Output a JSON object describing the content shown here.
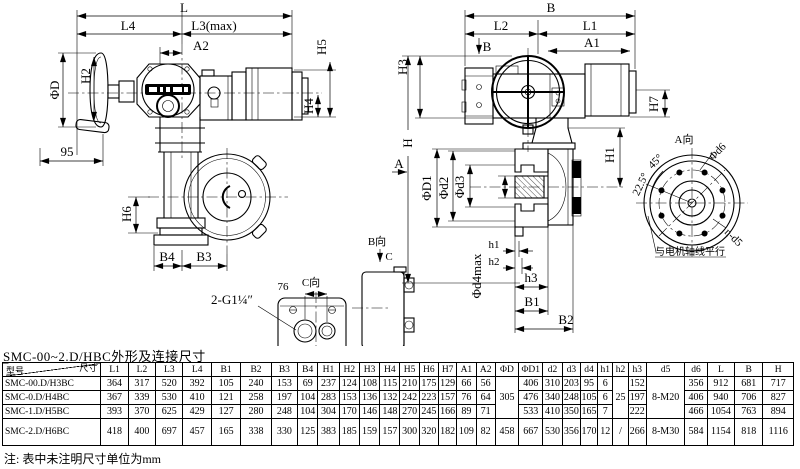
{
  "page": {
    "title": "SMC-00~2.D/HBC外形及连接尺寸",
    "note": "注: 表中未注明尺寸单位为mm"
  },
  "front_view": {
    "L": "L",
    "L4": "L4",
    "L3max": "L3(max)",
    "A2": "A2",
    "phiD": "ΦD",
    "H2": "H2",
    "H5": "H5",
    "H4": "H4",
    "n95": "95",
    "H6": "H6",
    "B4": "B4",
    "B3": "B3",
    "thread": "2-G1¼″",
    "n76": "76",
    "c_view_title": "C向",
    "b_view_title": "B向",
    "c_arrow": "C"
  },
  "side_view": {
    "B": "B",
    "L2": "L2",
    "L1": "L1",
    "A1": "A1",
    "b_arrow": "B",
    "H3": "H3",
    "H": "H",
    "a_arrow": "A",
    "H7": "H7",
    "H1": "H1",
    "phiD1": "ΦD1",
    "phid2": "Φd2",
    "phid3": "Φd3",
    "phid4max": "Φd4max",
    "h1": "h1",
    "h2": "h2",
    "h3": "h3",
    "B1": "B1",
    "B2": "B2"
  },
  "flange_view": {
    "title": "A向",
    "phid6": "Φd6",
    "deg45": "45°",
    "deg22_5": "22.5°",
    "nd5": "n-d5",
    "axis_note": "与电机轴线平行"
  },
  "table": {
    "corner_top": "尺寸",
    "corner_bottom": "型号",
    "columns": [
      "L1",
      "L2",
      "L3",
      "L4",
      "B1",
      "B2",
      "B3",
      "B4",
      "H1",
      "H2",
      "H3",
      "H4",
      "H5",
      "H6",
      "H7",
      "A1",
      "A2",
      "ΦD",
      "ΦD1",
      "d2",
      "d3",
      "d4",
      "h1",
      "h2",
      "h3",
      "d5",
      "d6",
      "L",
      "B",
      "H"
    ],
    "rows": [
      {
        "model": "SMC-00.D/H3BC",
        "cells": [
          "364",
          "317",
          "520",
          "392",
          "105",
          "240",
          "153",
          "69",
          "237",
          "124",
          "108",
          "115",
          "210",
          "175",
          "129",
          "66",
          "56",
          {
            "v": "305",
            "rowspan": 3
          },
          "406",
          "310",
          "203",
          "95",
          "6",
          {
            "v": "25",
            "rowspan": 3
          },
          "152",
          {
            "v": "8-M20",
            "rowspan": 3
          },
          "356",
          "912",
          "681",
          "717"
        ]
      },
      {
        "model": "SMC-0.D/H4BC",
        "cells": [
          "367",
          "339",
          "530",
          "410",
          "121",
          "258",
          "197",
          "104",
          "283",
          "153",
          "136",
          "132",
          "242",
          "223",
          "157",
          "76",
          "64",
          "476",
          "340",
          "248",
          "105",
          "6",
          "197",
          "406",
          "940",
          "706",
          "827"
        ]
      },
      {
        "model": "SMC-1.D/H5BC",
        "cells": [
          "393",
          "370",
          "625",
          "429",
          "127",
          "280",
          "248",
          "104",
          "304",
          "170",
          "146",
          "148",
          "270",
          "245",
          "166",
          "89",
          "71",
          "533",
          "410",
          "350",
          "165",
          "7",
          "222",
          "466",
          "1054",
          "763",
          "894"
        ]
      },
      {
        "model": "SMC-2.D/H6BC",
        "cells": [
          "418",
          "400",
          "697",
          "457",
          "165",
          "338",
          "330",
          "125",
          "383",
          "185",
          "159",
          "157",
          "300",
          "320",
          "182",
          "109",
          "82",
          "458",
          "667",
          "530",
          "356",
          "170",
          "12",
          "/",
          "266",
          "8-M30",
          "584",
          "1154",
          "818",
          "1116"
        ]
      }
    ]
  }
}
